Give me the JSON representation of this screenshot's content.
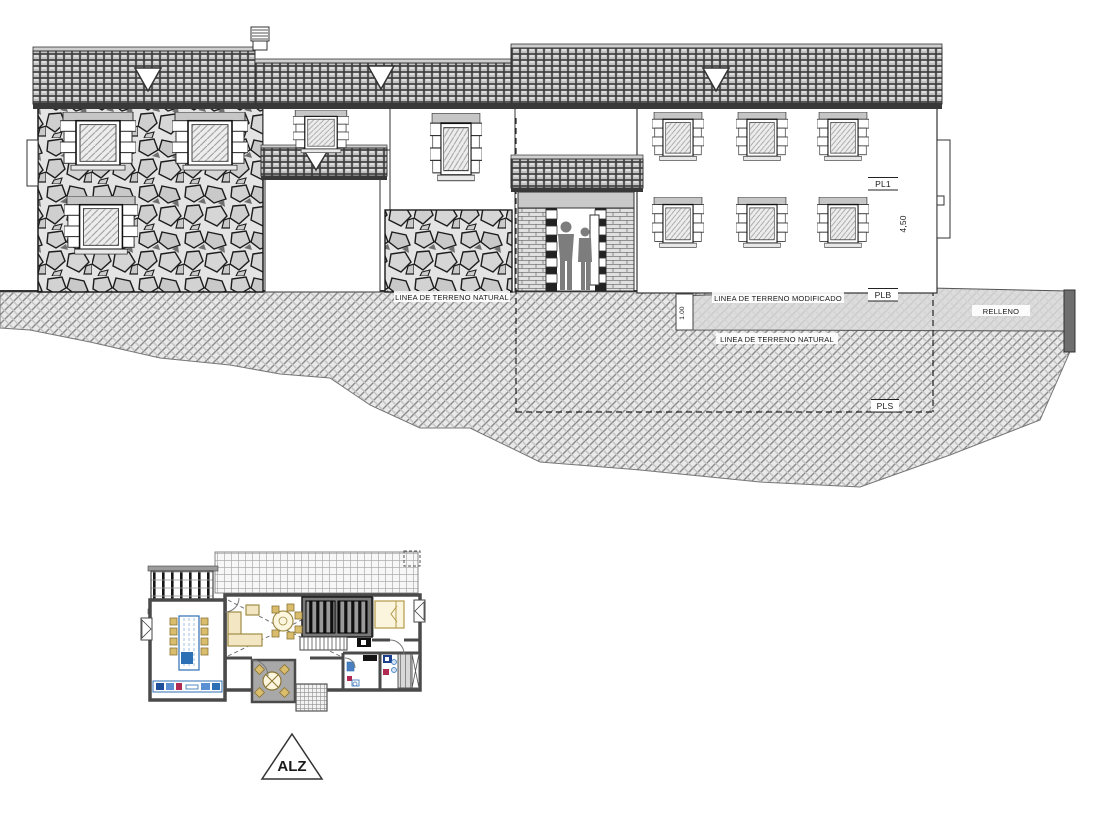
{
  "labels": {
    "terrain_natural_left": "LINEA DE TERRENO NATURAL",
    "terrain_modified": "LINEA DE TERRENO MODIFICADO",
    "terrain_natural_right": "LINEA DE TERRENO NATURAL",
    "relleno": "RELLENO",
    "pl1": "PL1",
    "plb": "PLB",
    "pls": "PLS",
    "dim_total_height": "4,50",
    "dim_fill_depth": "1.00",
    "view_marker": "ALZ"
  },
  "colors": {
    "paper": "#ffffff",
    "ink": "#1a1a1a",
    "terrain_hatch": "#8c8c8c",
    "modified_fill": "#d9d9d9",
    "furniture_tan": "#d9bd6d",
    "kitchen_blue": "#2d6fb5",
    "accent_red": "#b02a52"
  }
}
